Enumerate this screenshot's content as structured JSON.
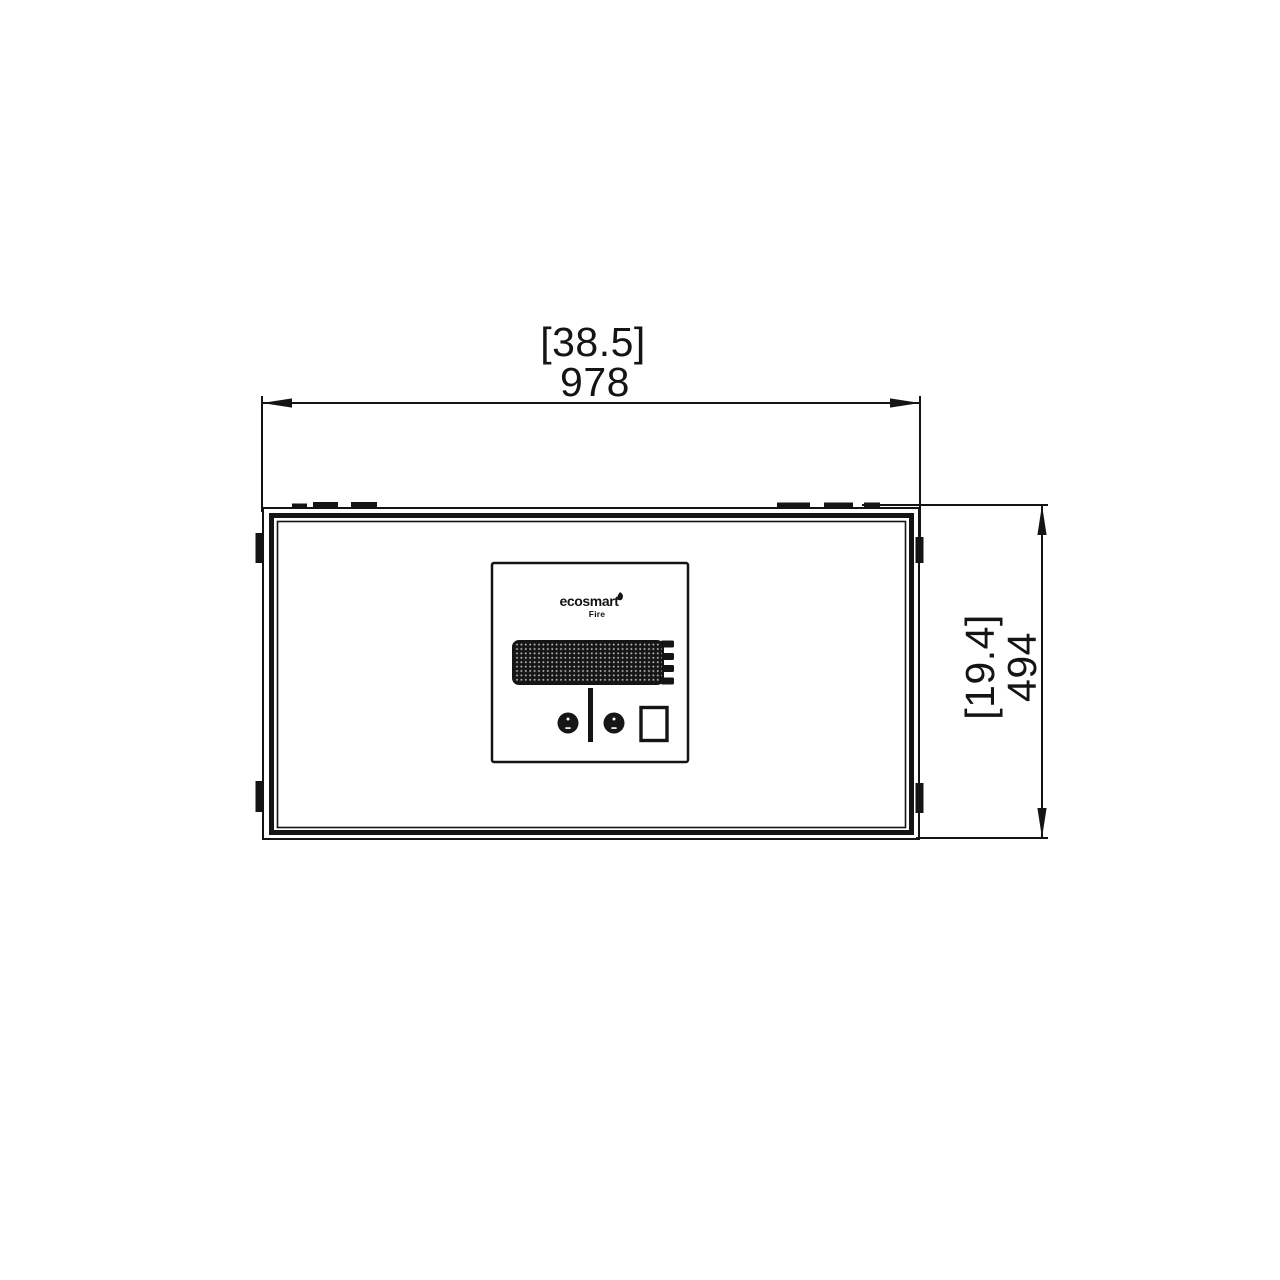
{
  "figure": {
    "kind": "technical-dimension-drawing",
    "background_color": "#ffffff",
    "line_color": "#141414",
    "display_dot_color": "#b9b9b9"
  },
  "dimensions": {
    "width": {
      "imperial_in": "[38.5]",
      "metric_mm": "978"
    },
    "height": {
      "imperial_in": "[19.4]",
      "metric_mm": "494"
    }
  },
  "control_panel": {
    "brand": "ecosmart",
    "brand_product": "Fire"
  }
}
